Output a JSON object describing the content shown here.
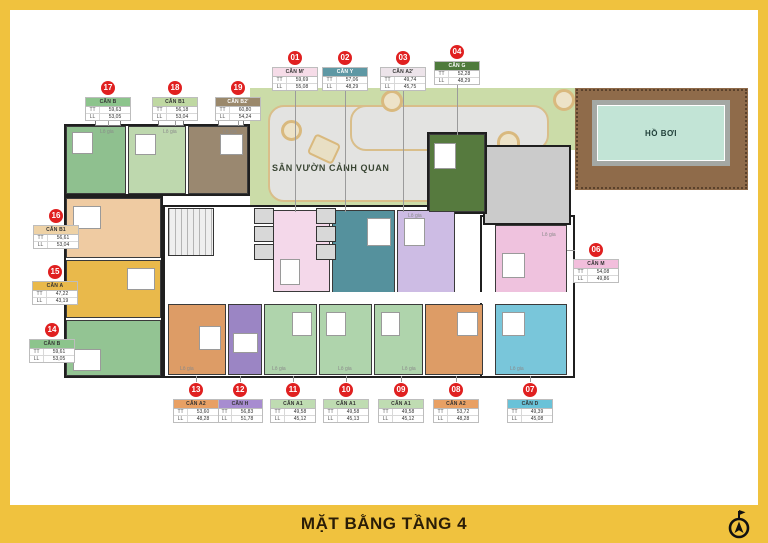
{
  "title_bar": {
    "title": "MẶT BẰNG TẦNG 4"
  },
  "areas": {
    "garden": {
      "label": "SÂN VƯỜN CẢNH QUAN",
      "fill": "#CBDCA8"
    },
    "pool": {
      "label": "HỒ BƠI",
      "deck_fill": "#8F6B4A",
      "water_fill": "#C2E4D6"
    }
  },
  "building": {
    "logia_label": "Lô gia"
  },
  "marker": {
    "badge_color": "#E02020",
    "row_labels": [
      "TT",
      "LL"
    ]
  },
  "units": [
    {
      "number": "01",
      "name": "CĂN M'",
      "tt": "59,69",
      "ll": "55,08",
      "header_color": "#F6DCE8",
      "header_text": "#333333",
      "fill": "#F4D8EA"
    },
    {
      "number": "02",
      "name": "CĂN Y",
      "tt": "57,06",
      "ll": "48,29",
      "header_color": "#5E98A4",
      "header_text": "#FFFFFF",
      "fill": "#55919D"
    },
    {
      "number": "03",
      "name": "CĂN A2'",
      "tt": "49,74",
      "ll": "45,75",
      "header_color": "#EDE4EA",
      "header_text": "#333333",
      "fill": "#CDBCE4"
    },
    {
      "number": "04",
      "name": "CĂN G",
      "tt": "52,28",
      "ll": "48,29",
      "header_color": "#4E7A3C",
      "header_text": "#FFFFFF",
      "fill": "#567A3E"
    },
    {
      "number": "06",
      "name": "CĂN M",
      "tt": "54,08",
      "ll": "49,86",
      "header_color": "#F2BEDC",
      "header_text": "#333333",
      "fill": "#EFC2DE"
    },
    {
      "number": "07",
      "name": "CĂN D",
      "tt": "49,39",
      "ll": "45,08",
      "header_color": "#69C2D8",
      "header_text": "#333333",
      "fill": "#79C6DA"
    },
    {
      "number": "08",
      "name": "CĂN A2",
      "tt": "53,72",
      "ll": "48,28",
      "header_color": "#E8A064",
      "header_text": "#333333",
      "fill": "#DD9C66"
    },
    {
      "number": "09",
      "name": "CĂN A1",
      "tt": "49,58",
      "ll": "45,12",
      "header_color": "#BFDCB2",
      "header_text": "#333333",
      "fill": "#AFD4AC"
    },
    {
      "number": "10",
      "name": "CĂN A1",
      "tt": "49,58",
      "ll": "45,13",
      "header_color": "#BFDCB2",
      "header_text": "#333333",
      "fill": "#AFD4AC"
    },
    {
      "number": "11",
      "name": "CĂN A1",
      "tt": "49,58",
      "ll": "45,12",
      "header_color": "#BFDCB2",
      "header_text": "#333333",
      "fill": "#AFD4AC"
    },
    {
      "number": "12",
      "name": "CĂN H",
      "tt": "56,83",
      "ll": "51,78",
      "header_color": "#A78CD0",
      "header_text": "#333333",
      "fill": "#9B85C4"
    },
    {
      "number": "13",
      "name": "CĂN A2",
      "tt": "53,60",
      "ll": "48,28",
      "header_color": "#E8A064",
      "header_text": "#333333",
      "fill": "#DD9C66"
    },
    {
      "number": "14",
      "name": "CĂN B",
      "tt": "59,61",
      "ll": "53,05",
      "header_color": "#8CC48C",
      "header_text": "#333333",
      "fill": "#93C493"
    },
    {
      "number": "15",
      "name": "CĂN A",
      "tt": "47,22",
      "ll": "43,19",
      "header_color": "#E9B94B",
      "header_text": "#333333",
      "fill": "#E9B94B"
    },
    {
      "number": "16",
      "name": "CĂN B1",
      "tt": "56,61",
      "ll": "53,04",
      "header_color": "#EED2A6",
      "header_text": "#333333",
      "fill": "#EFCBA2"
    },
    {
      "number": "17",
      "name": "CĂN B",
      "tt": "59,63",
      "ll": "53,05",
      "header_color": "#8CC48C",
      "header_text": "#333333",
      "fill": "#8FC08F"
    },
    {
      "number": "18",
      "name": "CĂN B1",
      "tt": "56,18",
      "ll": "53,04",
      "header_color": "#BFD8A2",
      "header_text": "#333333",
      "fill": "#BED8AE"
    },
    {
      "number": "19",
      "name": "CĂN B2'",
      "tt": "60,80",
      "ll": "54,24",
      "header_color": "#9A886B",
      "header_text": "#FFFFFF",
      "fill": "#9A8870"
    }
  ]
}
